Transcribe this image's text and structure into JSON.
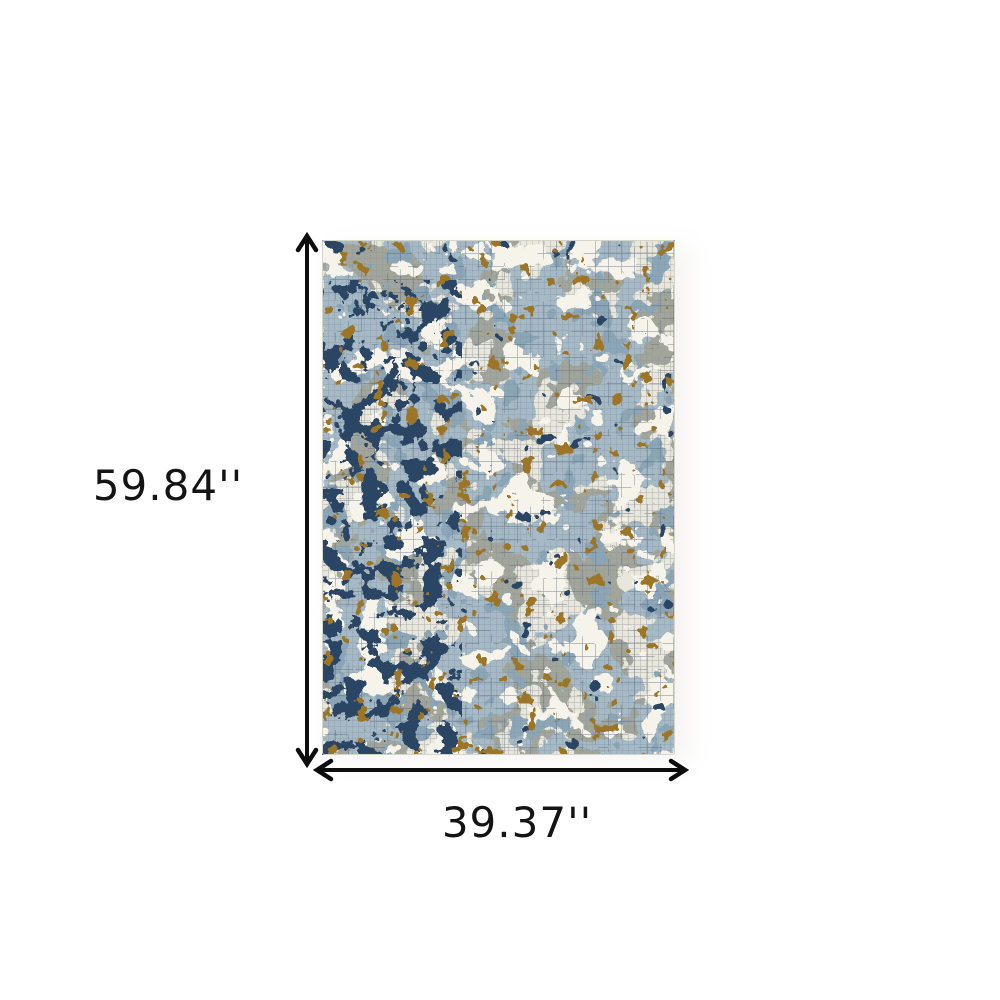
{
  "page": {
    "background": "#ffffff"
  },
  "dimensions": {
    "height_label": "59.84''",
    "width_label": "39.37''",
    "arrow_color": "#0d0d0d",
    "label_color": "#141414"
  },
  "rug": {
    "palette": {
      "base": "#e9e7db",
      "ivory": "#f5f3ea",
      "gray_green": "#a2a69a",
      "light_blue": "#a4bac7",
      "steel_blue": "#8aa7ba",
      "navy": "#2b4664",
      "ochre": "#9d7527",
      "grid_gray": "#8b9299",
      "grid_dark": "#51617a",
      "edge": "#d6d3c7"
    }
  }
}
